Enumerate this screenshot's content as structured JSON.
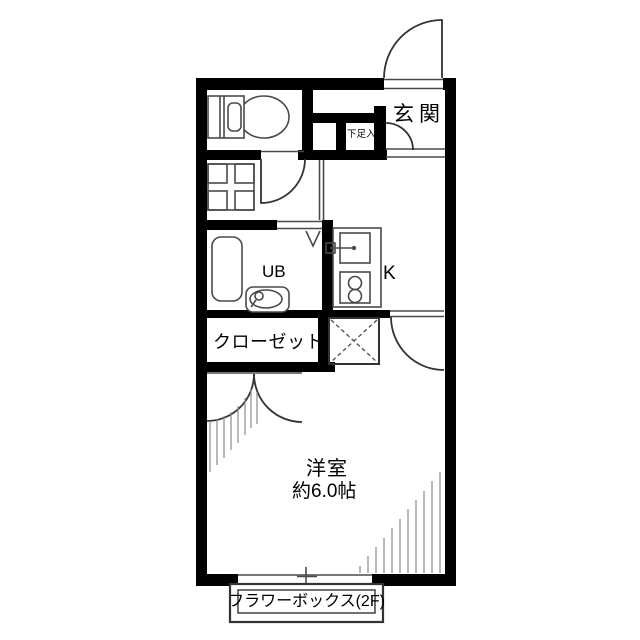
{
  "plan": {
    "rooms": {
      "entrance": "玄関",
      "shoe_cabinet": "下足入",
      "unit_bath": "UB",
      "kitchen": "K",
      "closet": "クローゼット",
      "main_room_name": "洋室",
      "main_room_size": "約6.0帖",
      "flower_box": "フラワーボックス(2F)"
    },
    "colors": {
      "wall": "#000000",
      "door_line": "#333333",
      "fixture_line": "#4a4a4a",
      "hatch_line": "#8a8a8a",
      "background": "#ffffff"
    }
  }
}
